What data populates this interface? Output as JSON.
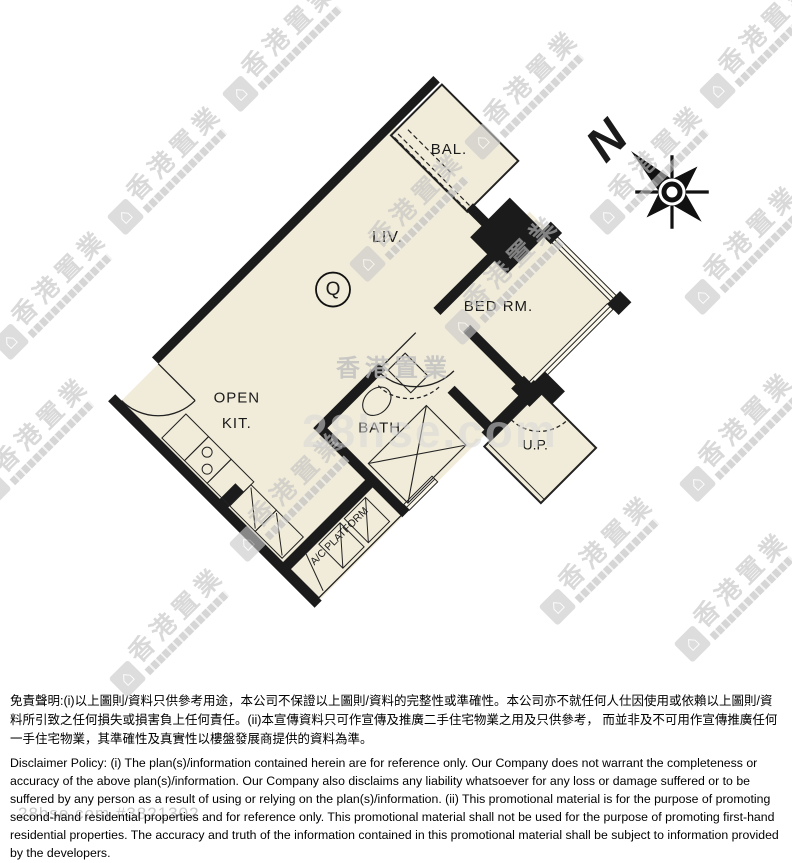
{
  "floor_plan": {
    "unit_mark": "Q",
    "labels": {
      "balcony": "BAL.",
      "living": "LIV.",
      "bedroom": "BED RM.",
      "kitchen_line1": "OPEN",
      "kitchen_line2": "KIT.",
      "bath": "BATH",
      "utility_platform": "U.P.",
      "ac_platform": "A/C PLATFORM"
    },
    "compass": {
      "north_label": "N"
    },
    "colors": {
      "floor": "#f1ecd9",
      "wall": "#1b1b1b",
      "watermark_gray": "#c7c7c7"
    }
  },
  "watermark": {
    "logo_text": "香港置業",
    "center_logo_text": "香港置業",
    "center_site_text": "28hse.com",
    "listing_ref": "28hse.com #3821302"
  },
  "disclaimer": {
    "chinese": "免責聲明:(i)以上圖則/資料只供參考用途，本公司不保證以上圖則/資料的完整性或準確性。本公司亦不就任何人仕因使用或依賴以上圖則/資料所引致之任何損失或損害負上任何責任。(ii)本宣傳資料只可作宣傳及推廣二手住宅物業之用及只供參考， 而並非及不可用作宣傳推廣任何一手住宅物業，其準確性及真實性以樓盤發展商提供的資料為準。",
    "english": "Disclaimer Policy: (i) The plan(s)/information contained herein are for reference only. Our Company does not warrant the completeness or accuracy of the above plan(s)/information. Our Company also disclaims any liability whatsoever for any loss or damage suffered or to be suffered by any person as a result of using or relying on the plan(s)/information. (ii) This promotional material is for the purpose of promoting second-hand residential properties and for reference only. This promotional material shall not be used for the purpose of promoting first-hand residential properties. The accuracy and truth of the information contained in this promotional material shall be subject to information provided by the developers."
  }
}
